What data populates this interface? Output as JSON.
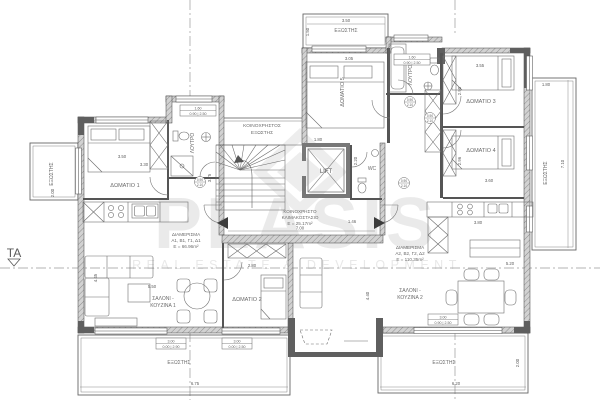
{
  "plan": {
    "section_marker": "TA",
    "watermark": {
      "brand": "PLASIS",
      "tagline": "REAL ESTATE & DEVELOPMENT"
    },
    "common_areas": {
      "stairwell": {
        "line1": "ΚΟΙΝΟΧΡΗΣΤΟ",
        "line2": "ΚΛΙΜΑΚΟΣΤΑΣΙΟ",
        "line3": "Ε = 25.17m²"
      },
      "shared_balcony": {
        "line1": "ΚΟΙΝΟΧΡΗΣΤΟΣ",
        "line2": "ΕΞΩΣΤΗΣ"
      },
      "lift": "LIFT",
      "wc": "WC"
    },
    "apartment1": {
      "label": {
        "line1": "ΔΙΑΜΕΡΙΣΜΑ",
        "line2": "Α1, Β1, Γ1, Δ1",
        "line3": "Ε = 66.96m²"
      },
      "living": {
        "line1": "ΣΑΛΟΝΙ -",
        "line2": "ΚΟΥΖΙΝΑ 1"
      },
      "room1": "ΔΩΜΑΤΙΟ 1",
      "room2": "ΔΩΜΑΤΙΟ 2",
      "bath": "ΛΟΥΤΡΟ"
    },
    "apartment2": {
      "label": {
        "line1": "ΔΙΑΜΕΡΙΣΜΑ",
        "line2": "Α2, Β2, Γ2, Δ2",
        "line3": "Ε = 110.35m²"
      },
      "living": {
        "line1": "ΣΑΛΟΝΙ -",
        "line2": "ΚΟΥΖΙΝΑ 2"
      },
      "room3": "ΔΩΜΑΤΙΟ 3",
      "room4": "ΔΩΜΑΤΙΟ 4",
      "room5": "ΔΩΜΑΤΙΟ 5",
      "bath": "ΛΟΥΤΡΟ"
    },
    "balconies": {
      "top": "ΕΞΩΣΤΗΣ",
      "left": "ΕΞΩΣΤΗΣ",
      "right": "ΕΞΩΣΤΗΣ",
      "bottom_left": "ΕΞΩΣΤΗΣ",
      "bottom_right": "ΕΞΩΣΤΗΣ"
    },
    "dims": {
      "top_w": "3.50",
      "top_h": "1.50",
      "left_h": "2.00",
      "right_w": "1.80",
      "right_h": "7.10",
      "bl_w": "6.75",
      "bl_h": "2.00",
      "br_w": "6.20",
      "br_h": "2.00",
      "room1_w": "3.50",
      "room1_h": "3.30",
      "room5_w": "3.05",
      "room3_w": "3.55",
      "room3_h": "2.90",
      "room4_w": "3.60",
      "room4_h": "2.96",
      "room2_w": "2.80",
      "living1_w": "5.50",
      "living1_h": "4.45",
      "living2_w": "5.20",
      "living2_h": "4.40",
      "kitchen2_w": "3.80",
      "hall_w": "7.00",
      "stair_h": "3.75",
      "entry_w": "1.46",
      "lift_w": "1.80",
      "wc_h": "2.20"
    },
    "dim_boxes": [
      {
        "top": "1.60",
        "bottom": "0.90 | 2.50"
      },
      {
        "top": "1.60",
        "bottom": "0.90 | 2.50"
      },
      {
        "top": "3.00",
        "bottom": "0.00 | 2.90"
      },
      {
        "top": "3.00",
        "bottom": "0.00 | 2.50"
      },
      {
        "top": "3.00",
        "bottom": "0.90 | 2.50"
      }
    ],
    "door_tags": [
      {
        "top": "0.90",
        "bottom": "2.10"
      },
      {
        "top": "0.90",
        "bottom": "2.10"
      },
      {
        "top": "0.90",
        "bottom": "2.10"
      },
      {
        "top": "0.90",
        "bottom": "2.10"
      }
    ]
  }
}
